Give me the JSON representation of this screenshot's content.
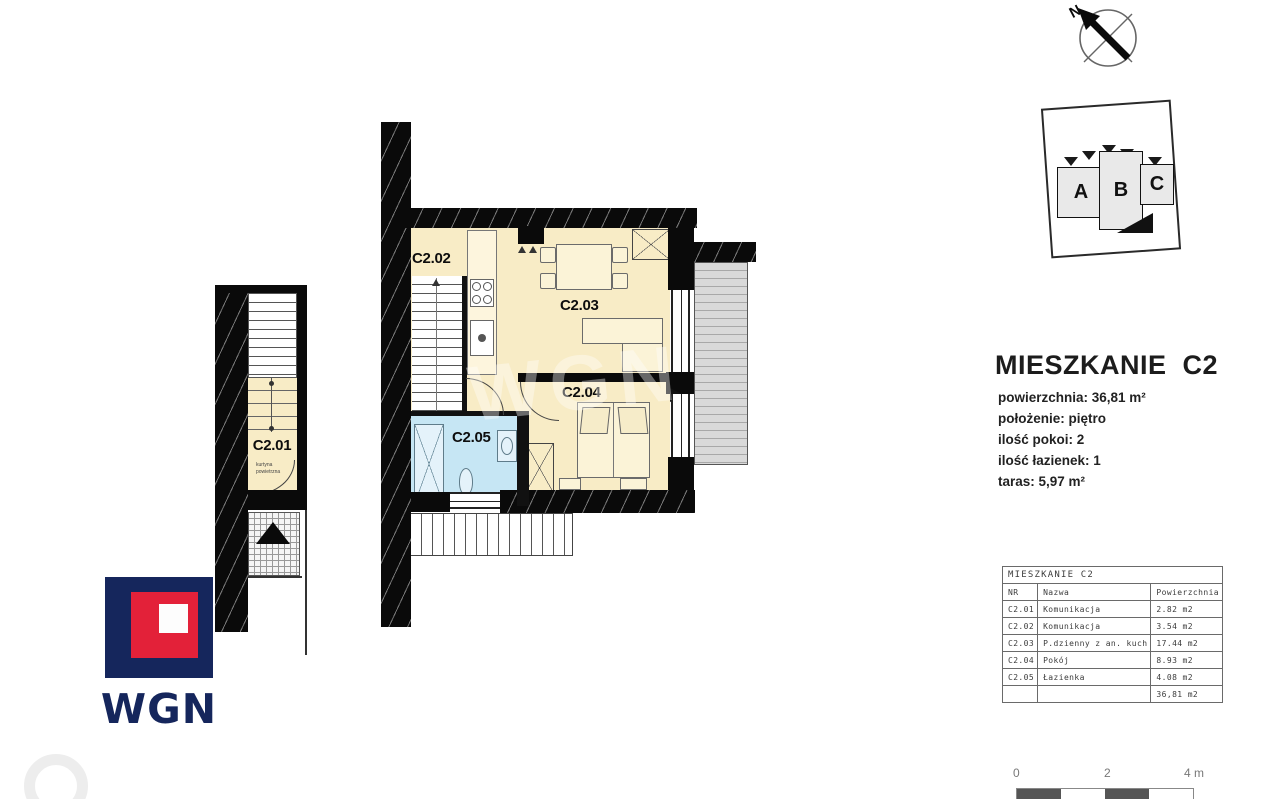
{
  "north_arrow": {
    "label": "N"
  },
  "building_key": {
    "block_a": "A",
    "block_b": "B",
    "block_c": "C"
  },
  "title_block": {
    "title": "MIESZKANIE  C2",
    "line_area": "powierzchnia: 36,81 m²",
    "line_floor": "położenie: piętro",
    "line_rooms": "ilość pokoi: 2",
    "line_baths": "ilość łazienek: 1",
    "line_terrace": "taras: 5,97 m²"
  },
  "plan_labels": {
    "c201": "C2.01",
    "c202": "C2.02",
    "c203": "C2.03",
    "c204": "C2.04",
    "c205": "C2.05"
  },
  "entrance_note": {
    "line1": "kurtyna",
    "line2": "powietrzna"
  },
  "room_table": {
    "title": "MIESZKANIE C2",
    "header_nr": "NR",
    "header_name": "Nazwa",
    "header_area": "Powierzchnia",
    "rows": [
      {
        "nr": "C2.01",
        "name": "Komunikacja",
        "area": "2.82 m2"
      },
      {
        "nr": "C2.02",
        "name": "Komunikacja",
        "area": "3.54 m2"
      },
      {
        "nr": "C2.03",
        "name": "P.dzienny z an. kuch",
        "area": "17.44 m2"
      },
      {
        "nr": "C2.04",
        "name": "Pokój",
        "area": "8.93 m2"
      },
      {
        "nr": "C2.05",
        "name": "Łazienka",
        "area": "4.08 m2"
      }
    ],
    "total_area": "36,81 m2"
  },
  "scale_bar": {
    "tick0": "0",
    "tick1": "2",
    "tick2": "4 m"
  },
  "logo": {
    "text": "WGN"
  },
  "watermark": {
    "text": "WGN"
  },
  "colors": {
    "room_fill": "#f8ecc6",
    "bathroom_fill": "#c6e6f4",
    "terrace_fill": "#d9d9d9",
    "wall": "#0a0a0a",
    "logo_navy": "#15265c",
    "logo_red": "#e32139"
  }
}
